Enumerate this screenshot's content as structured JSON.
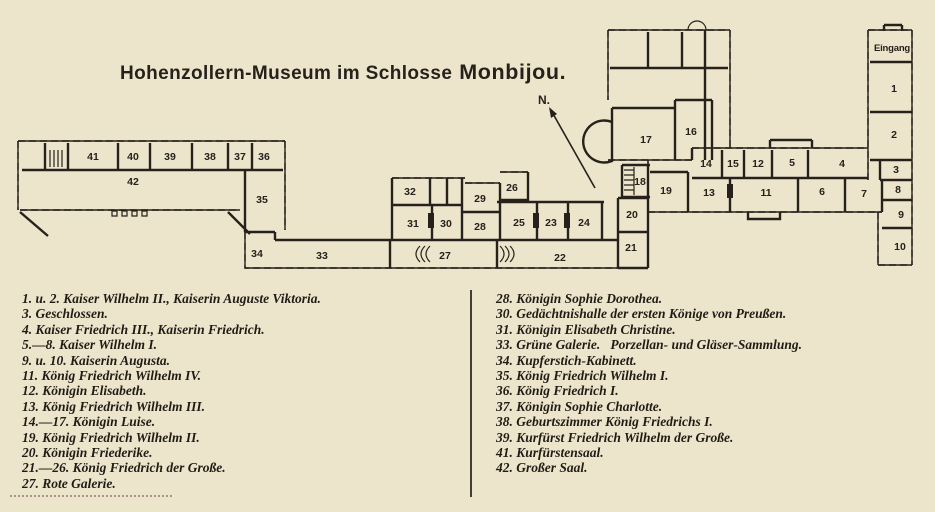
{
  "title": {
    "prefix": "Hohenzollern-Museum im Schlosse",
    "emphasis": "Monbijou."
  },
  "colors": {
    "paper": "#ece5cc",
    "ink": "#26211a"
  },
  "plan": {
    "entrance_label": "Eingang",
    "north_label": "N.",
    "rooms": [
      {
        "n": "41",
        "x": 93,
        "y": 160
      },
      {
        "n": "40",
        "x": 133,
        "y": 160
      },
      {
        "n": "39",
        "x": 170,
        "y": 160
      },
      {
        "n": "38",
        "x": 210,
        "y": 160
      },
      {
        "n": "37",
        "x": 240,
        "y": 160
      },
      {
        "n": "36",
        "x": 264,
        "y": 160
      },
      {
        "n": "42",
        "x": 133,
        "y": 185
      },
      {
        "n": "35",
        "x": 262,
        "y": 203
      },
      {
        "n": "34",
        "x": 257,
        "y": 257
      },
      {
        "n": "33",
        "x": 322,
        "y": 259
      },
      {
        "n": "32",
        "x": 410,
        "y": 195
      },
      {
        "n": "31",
        "x": 413,
        "y": 227
      },
      {
        "n": "30",
        "x": 446,
        "y": 227
      },
      {
        "n": "29",
        "x": 480,
        "y": 202
      },
      {
        "n": "28",
        "x": 480,
        "y": 230
      },
      {
        "n": "26",
        "x": 512,
        "y": 191
      },
      {
        "n": "27",
        "x": 445,
        "y": 259
      },
      {
        "n": "25",
        "x": 519,
        "y": 226
      },
      {
        "n": "23",
        "x": 551,
        "y": 226
      },
      {
        "n": "24",
        "x": 584,
        "y": 226
      },
      {
        "n": "22",
        "x": 560,
        "y": 261
      },
      {
        "n": "18",
        "x": 640,
        "y": 185
      },
      {
        "n": "19",
        "x": 666,
        "y": 194
      },
      {
        "n": "20",
        "x": 632,
        "y": 218
      },
      {
        "n": "21",
        "x": 631,
        "y": 251
      },
      {
        "n": "17",
        "x": 646,
        "y": 143
      },
      {
        "n": "16",
        "x": 691,
        "y": 135
      },
      {
        "n": "14",
        "x": 706,
        "y": 167
      },
      {
        "n": "15",
        "x": 733,
        "y": 167
      },
      {
        "n": "12",
        "x": 758,
        "y": 167
      },
      {
        "n": "5",
        "x": 792,
        "y": 166
      },
      {
        "n": "4",
        "x": 842,
        "y": 167
      },
      {
        "n": "3",
        "x": 896,
        "y": 173
      },
      {
        "n": "13",
        "x": 709,
        "y": 196
      },
      {
        "n": "11",
        "x": 766,
        "y": 196
      },
      {
        "n": "6",
        "x": 822,
        "y": 195
      },
      {
        "n": "7",
        "x": 864,
        "y": 197
      },
      {
        "n": "8",
        "x": 898,
        "y": 193
      },
      {
        "n": "2",
        "x": 894,
        "y": 138
      },
      {
        "n": "1",
        "x": 894,
        "y": 92
      },
      {
        "n": "9",
        "x": 901,
        "y": 218
      },
      {
        "n": "10",
        "x": 900,
        "y": 250
      }
    ]
  },
  "legend": {
    "left": [
      "1. u. 2. Kaiser Wilhelm II., Kaiserin Auguste Viktoria.",
      "3. Geschlossen.",
      "4. Kaiser Friedrich III., Kaiserin Friedrich.",
      "5.—8. Kaiser Wilhelm I.",
      "9. u. 10. Kaiserin Augusta.",
      "11. König Friedrich Wilhelm IV.",
      "12. Königin Elisabeth.",
      "13. König Friedrich Wilhelm III.",
      "14.—17. Königin Luise.",
      "19. König Friedrich Wilhelm II.",
      "20. Königin Friederike.",
      "21.—26. König Friedrich der Große.",
      "27. Rote Galerie."
    ],
    "right": [
      "28. Königin Sophie Dorothea.",
      "30. Gedächtnishalle der ersten Könige von Preußen.",
      "31. Königin Elisabeth Christine.",
      "33. Grüne Galerie.   Porzellan- und Gläser-Sammlung.",
      "34. Kupferstich-Kabinett.",
      "35. König Friedrich Wilhelm I.",
      "36. König Friedrich I.",
      "37. Königin Sophie Charlotte.",
      "38. Geburtszimmer König Friedrichs I.",
      "39. Kurfürst Friedrich Wilhelm der Große.",
      "41. Kurfürstensaal.",
      "42. Großer Saal."
    ]
  }
}
